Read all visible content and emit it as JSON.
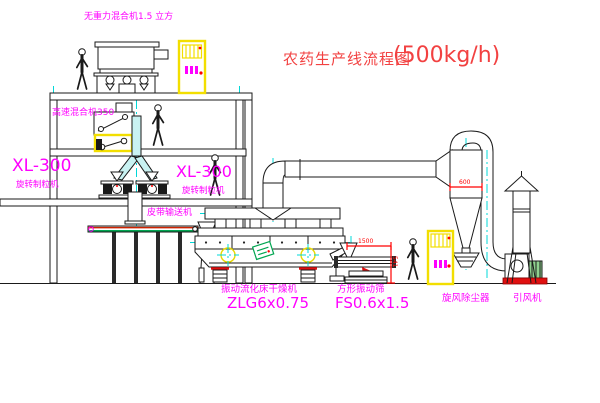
{
  "title": {
    "name": "农药生产线流程图",
    "capacity": "(500kg/h)"
  },
  "equipment_labels": {
    "gravity_free_mixer": "无重力混合机1.5 立方",
    "high_speed_mixer": "高速混合机350",
    "granulator_left_model": "XL-300",
    "granulator_left_name": "旋转制粒机",
    "granulator_right_model": "XL-300",
    "granulator_right_name": "旋转制粒机",
    "belt_conveyor": "皮带输送机",
    "fluid_bed_dryer_name": "振动流化床干燥机",
    "fluid_bed_dryer_model": "ZLG6x0.75",
    "vibrating_screen_name": "方形振动筛",
    "vibrating_screen_model": "FS0.6x1.5",
    "cyclone_dust_collector": "旋风除尘器",
    "induced_draft_fan": "引风机"
  },
  "dimensions": {
    "screen_length": "1500",
    "screen_height": "541",
    "cyclone_diameter": "600"
  },
  "colors": {
    "label_magenta": "#ff00ff",
    "title_red": "#f24141",
    "dimension_red": "#ff0000",
    "centerline_cyan": "#00d8d8",
    "cabinet_yellow": "#f2de00",
    "machine_green": "#00a651"
  }
}
